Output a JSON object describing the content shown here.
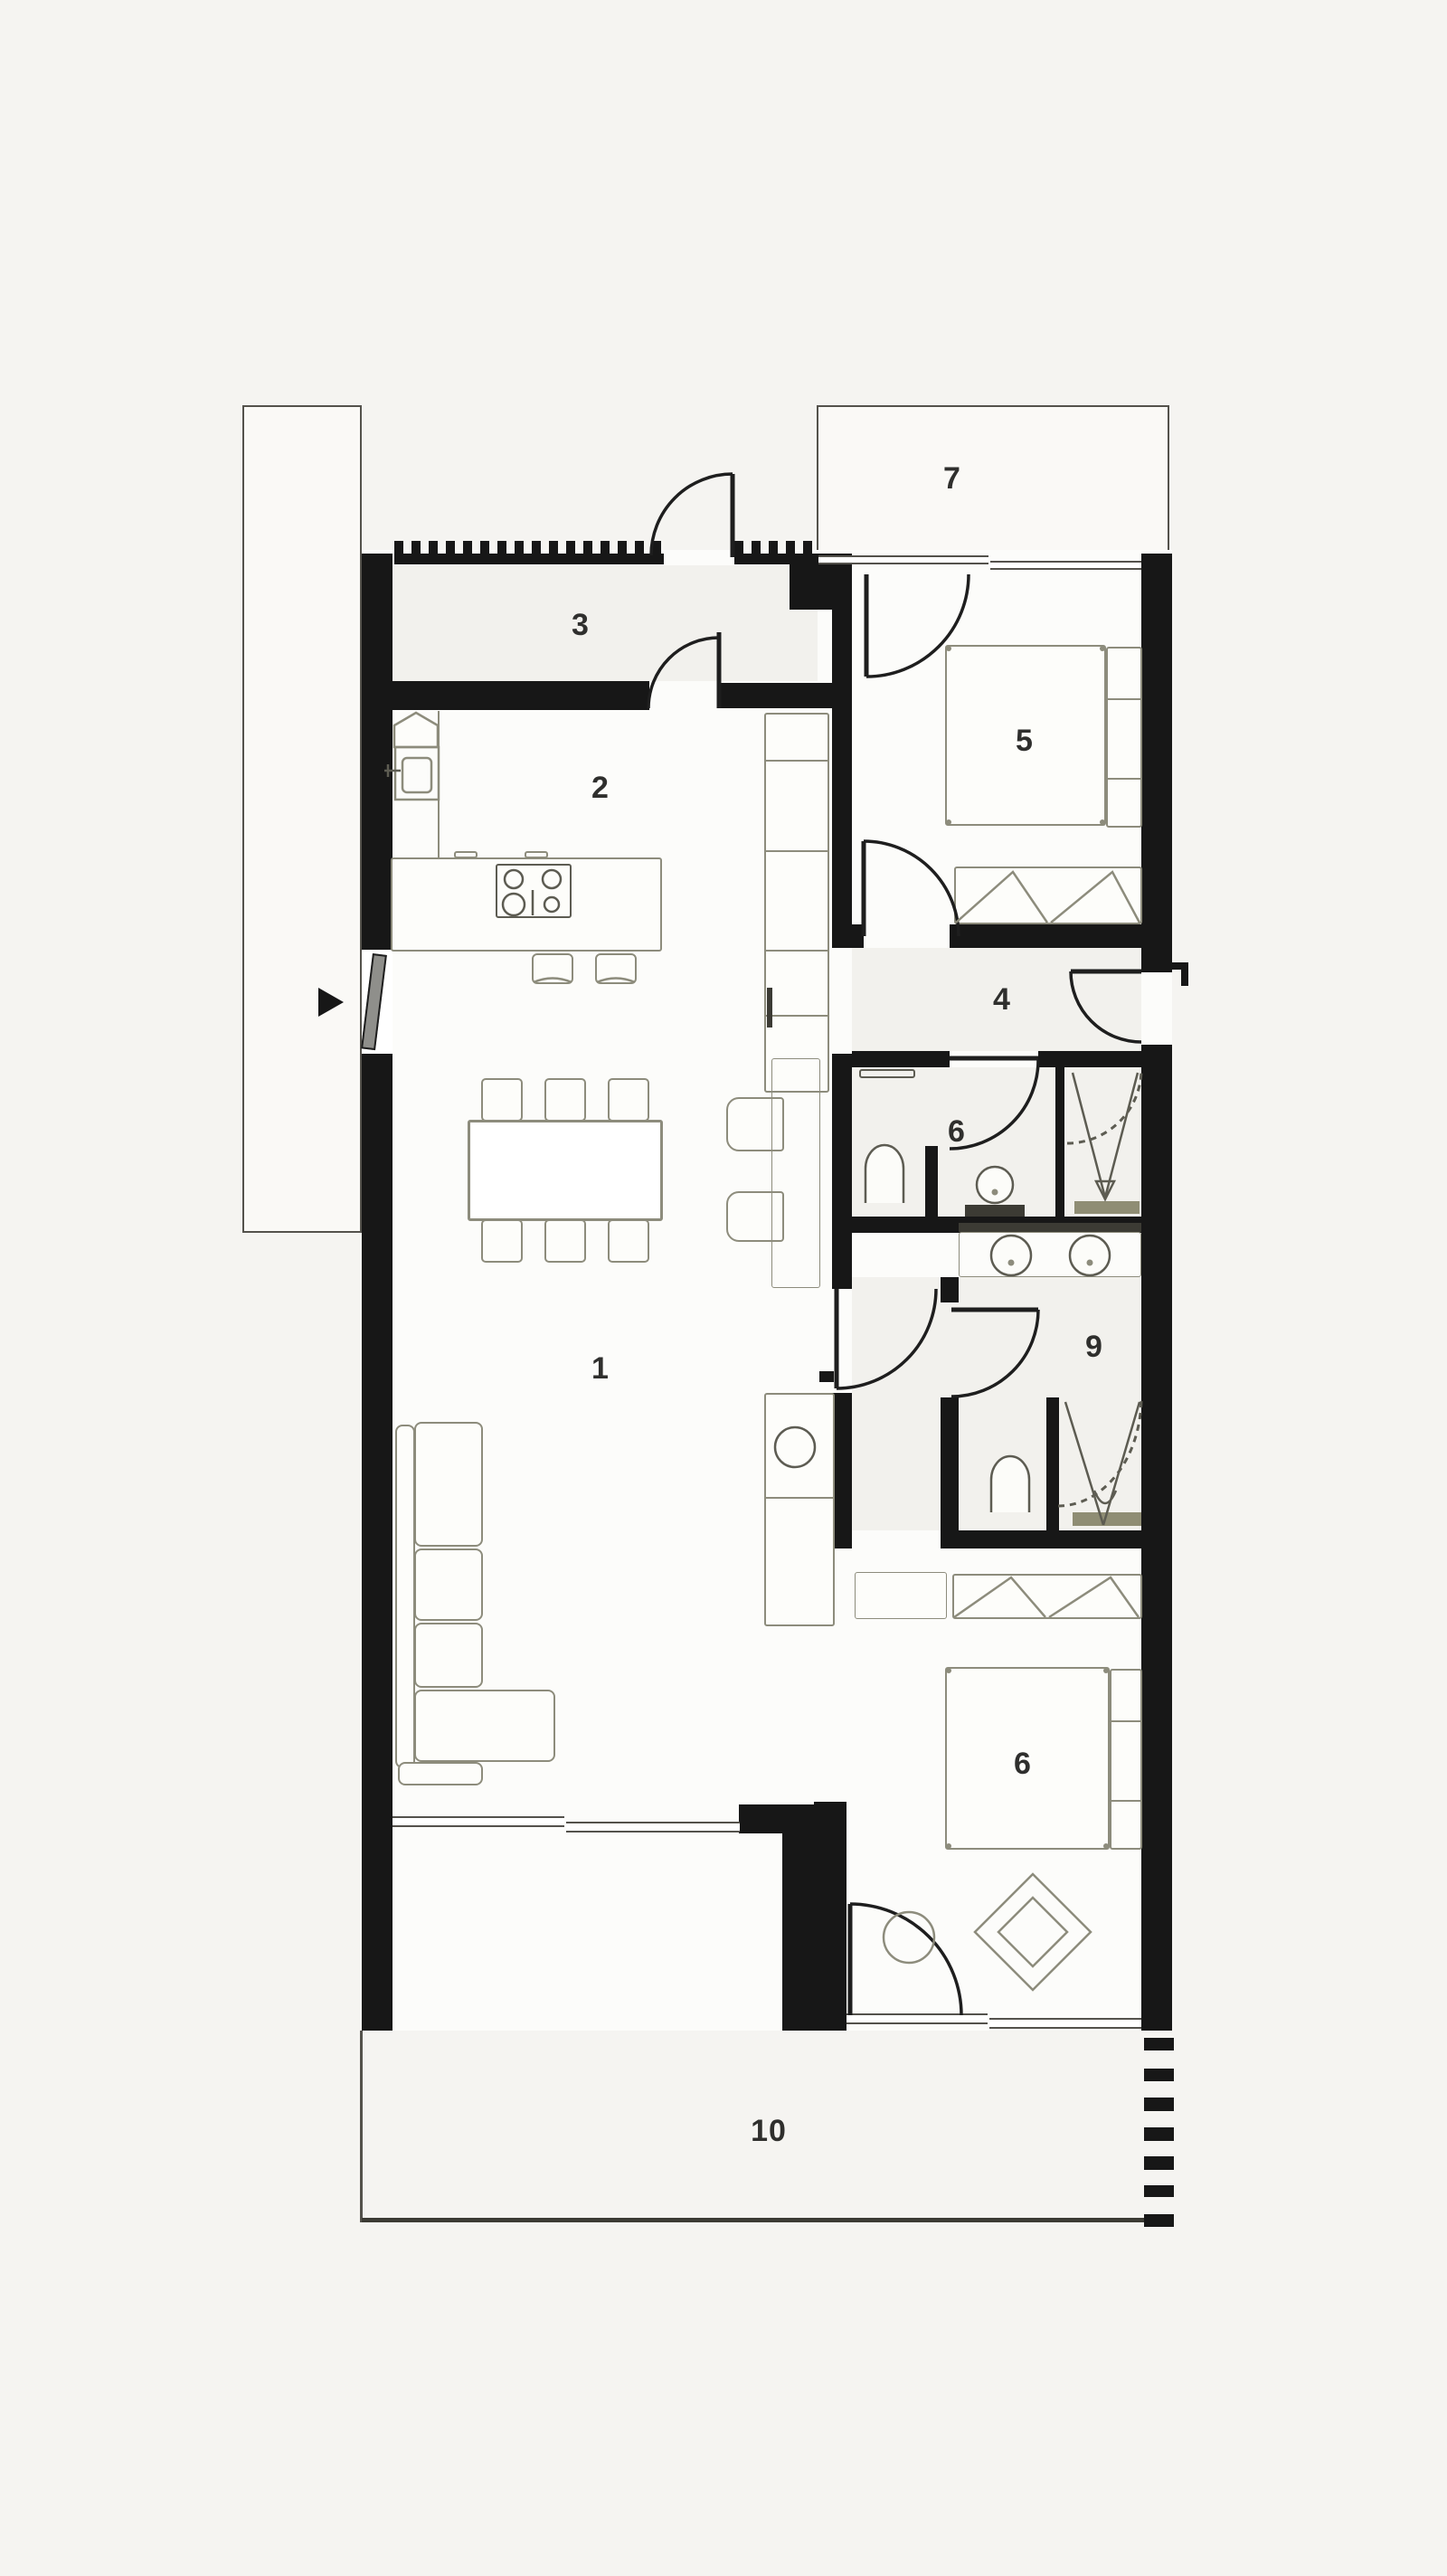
{
  "title": "apartment-floor-plan",
  "labels": {
    "living": "1",
    "kitchen": "2",
    "entry": "3",
    "hallway": "4",
    "bedroom_upper": "5",
    "bathroom_upper": "6",
    "balcony": "7",
    "bedroom_lower": "6",
    "bathroom_lower": "9",
    "terrace": "10"
  },
  "colors": {
    "background": "#f5f4f1",
    "paper": "#faf9f6",
    "floor": "#fcfcfa",
    "zone": "#f2f1ed",
    "wall": "#171717",
    "outline": "#54524c",
    "furniture": "#8d8c7c",
    "fixture": "#5d5c52",
    "door": "#1e1e1e",
    "door_panel": "#8f8f8b",
    "counter_dark": "#3c3b34",
    "bench": "#8f8d74",
    "label": "#2f2f2d"
  }
}
